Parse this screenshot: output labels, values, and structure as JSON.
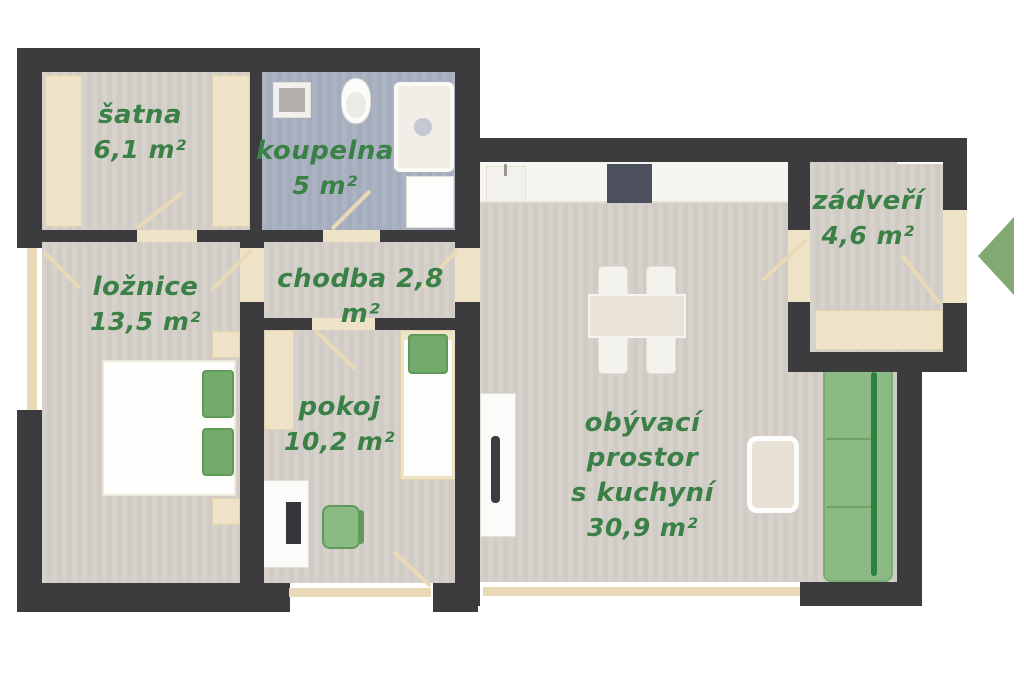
{
  "plan_title": "apartment-floor-plan",
  "colors": {
    "wall": "#3c3c3f",
    "floor": "#d3cfc9",
    "bath_floor": "#a9b1c0",
    "wood": "#efe3c7",
    "accent_green": "#8cba84",
    "label_green": "#3b8147",
    "arrow_green": "#82a873"
  },
  "rooms": [
    {
      "id": "satna",
      "name": "šatna",
      "area": "6,1 m²"
    },
    {
      "id": "koupelna",
      "name": "koupelna",
      "area": "5 m²"
    },
    {
      "id": "loznice",
      "name": "ložnice",
      "area": "13,5 m²"
    },
    {
      "id": "chodba",
      "name": "chodba",
      "area": "2,8 m²",
      "combined": "chodba 2,8 m²"
    },
    {
      "id": "pokoj",
      "name": "pokoj",
      "area": "10,2 m²"
    },
    {
      "id": "obyvaci",
      "name": "obývací prostor",
      "name2": "s kuchyní",
      "area": "30,9 m²"
    },
    {
      "id": "zadveri",
      "name": "zádveří",
      "area": "4,6 m²"
    }
  ]
}
